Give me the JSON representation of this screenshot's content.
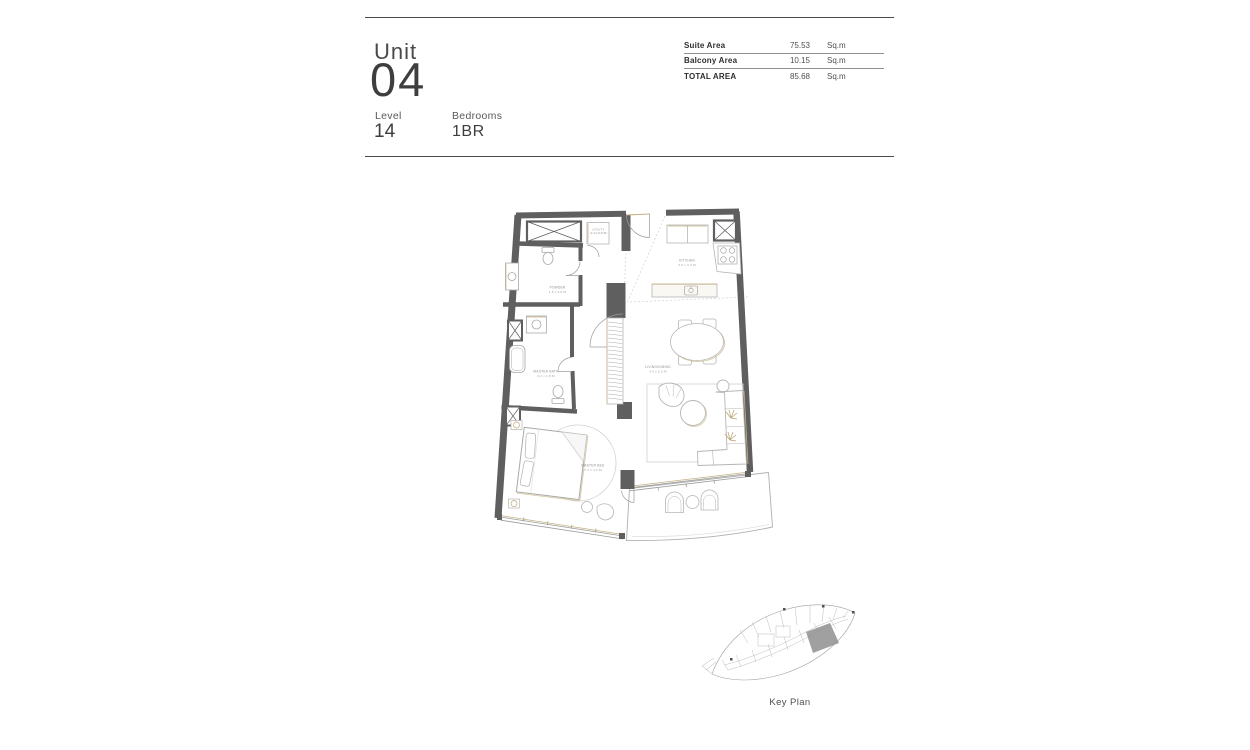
{
  "header": {
    "unit_label": "Unit",
    "unit_number": "04",
    "level_label": "Level",
    "level_value": "14",
    "bedrooms_label": "Bedrooms",
    "bedrooms_value": "1BR"
  },
  "area_table": {
    "rows": [
      {
        "label": "Suite Area",
        "value": "75.53",
        "unit": "Sq.m"
      },
      {
        "label": "Balcony Area",
        "value": "10.15",
        "unit": "Sq.m"
      },
      {
        "label": "TOTAL AREA",
        "value": "85.68",
        "unit": "Sq.m"
      }
    ]
  },
  "floor_plan": {
    "rooms": [
      {
        "name": "UTILITY",
        "dims": "1.1 x 0.9 M"
      },
      {
        "name": "KITCHEN",
        "dims": "3.5 x 3.4 M"
      },
      {
        "name": "POWDER",
        "dims": "1.5 x 2.0 M"
      },
      {
        "name": "MASTER BATH",
        "dims": "3.2 x 1.8 M"
      },
      {
        "name": "LIVING/DINING",
        "dims": "4.0 x 5.5 M"
      },
      {
        "name": "MASTER BED",
        "dims": "3.7 x 4.2 M"
      }
    ]
  },
  "key_plan": {
    "label": "Key Plan"
  },
  "colors": {
    "wall": "#5f5f5f",
    "gold_accent": "#c8b183",
    "light_line": "#b5b5b5",
    "text_dark": "#3e3e3e",
    "text_muted": "#8c8c8c"
  }
}
